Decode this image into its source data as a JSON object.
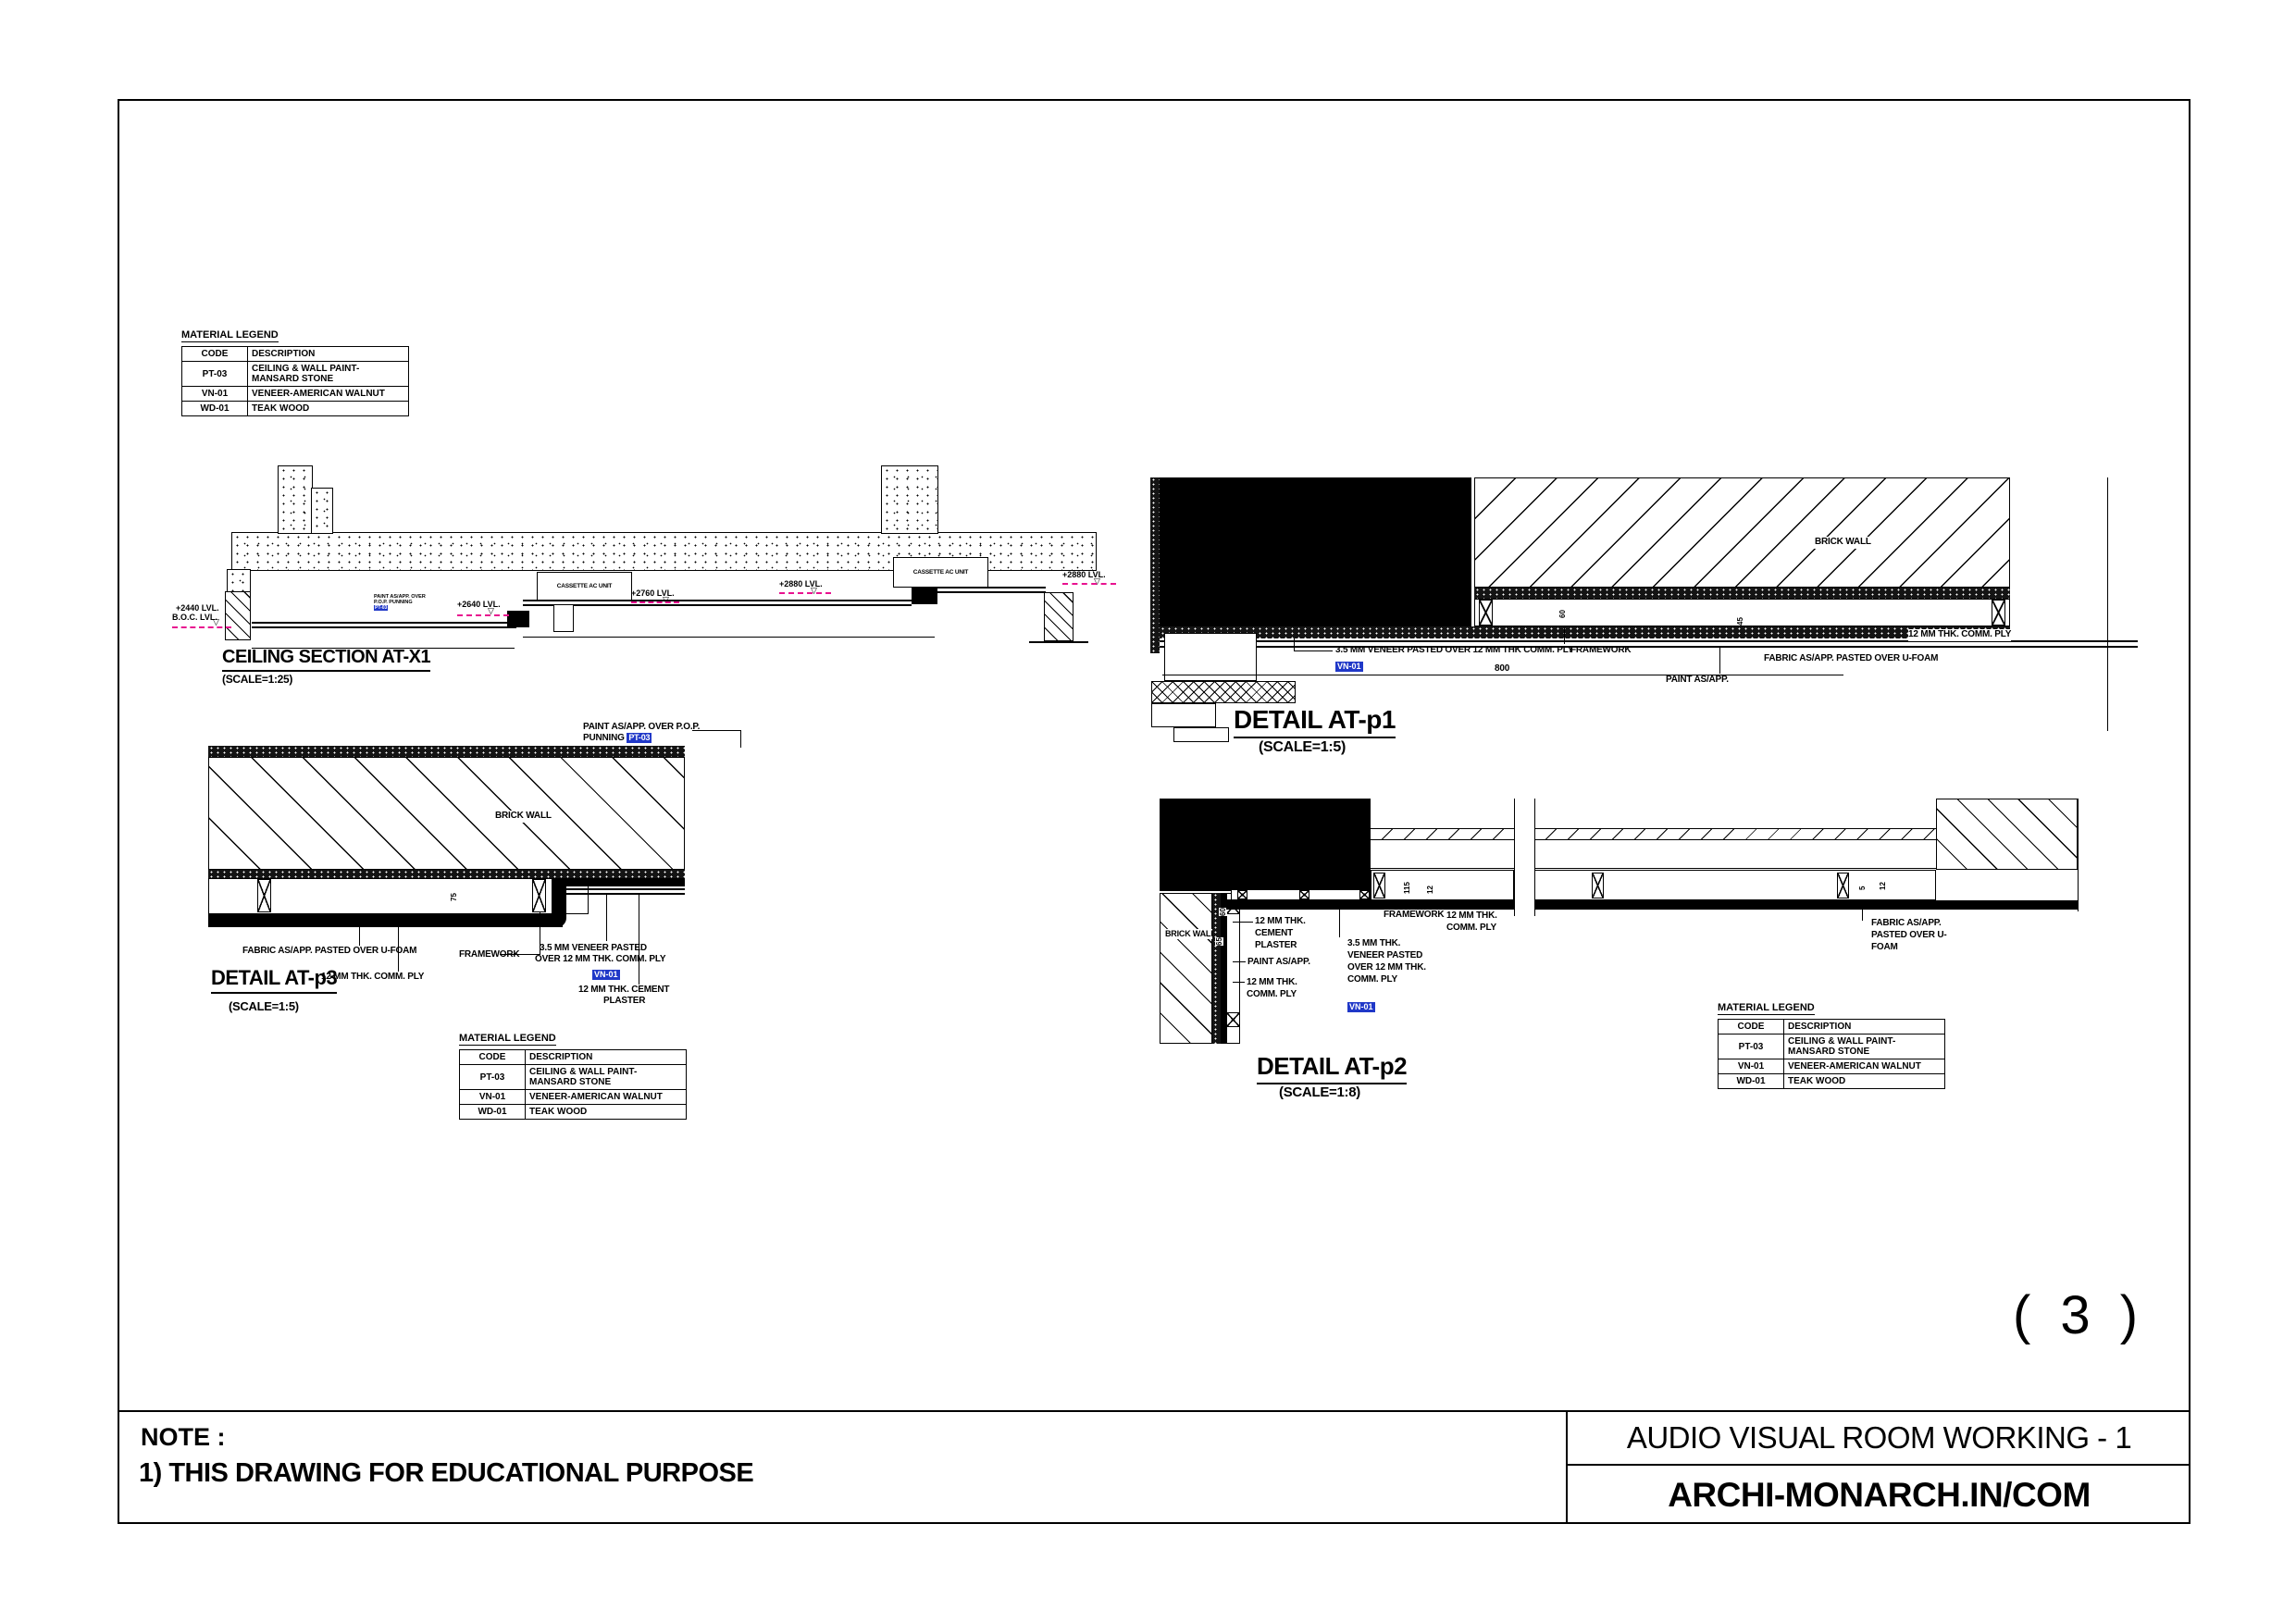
{
  "page": {
    "number": "( 3 )"
  },
  "note": {
    "heading": "NOTE :",
    "line_1": "1) THIS DRAWING FOR EDUCATIONAL PURPOSE"
  },
  "title_block": {
    "project": "AUDIO VISUAL ROOM WORKING - 1",
    "brand": "ARCHI-MONARCH.IN/COM"
  },
  "legend": {
    "title": "MATERIAL LEGEND",
    "columns": {
      "code": "CODE",
      "desc": "DESCRIPTION"
    },
    "rows": [
      {
        "code": "PT-03",
        "desc": "CEILING & WALL PAINT-MANSARD STONE"
      },
      {
        "code": "VN-01",
        "desc": "VENEER-AMERICAN WALNUT"
      },
      {
        "code": "WD-01",
        "desc": "TEAK WOOD"
      }
    ]
  },
  "colors": {
    "tag_blue": "#2038C8",
    "level_magenta": "#E8128F"
  },
  "ceiling_section": {
    "title": "CEILING SECTION AT-X1",
    "scale": "(SCALE=1:25)",
    "ac_unit_1": "CASSETTE AC UNIT",
    "ac_unit_2": "CASSETTE AC UNIT",
    "level_2440": "+2440 LVL.",
    "level_boc": "B.O.C. LVL.",
    "level_2640": "+2640 LVL.",
    "level_2760": "+2760 LVL.",
    "level_2880_mid": "+2880 LVL.",
    "level_2880_right": "+2880 LVL.",
    "tiny_note_line_1": "PAINT AS/APP. OVER",
    "tiny_note_line_2": "P.O.P. PUNNING",
    "tiny_note_tag": "PT-03"
  },
  "detail_p1": {
    "title": "DETAIL AT-p1",
    "scale": "(SCALE=1:5)",
    "brick_wall": "BRICK WALL",
    "veneer": "3.5 MM VENEER PASTED OVER 12 MM THK COMM. PLY",
    "veneer_tag": "VN-01",
    "framework": "FRAMEWORK",
    "paint": "PAINT AS/APP.",
    "fabric": "FABRIC AS/APP. PASTED OVER U-FOAM",
    "ply": "12 MM THK. COMM. PLY",
    "dim_800": "800",
    "dim_60": "60",
    "dim_45": "45"
  },
  "detail_p3": {
    "title": "DETAIL AT-p3",
    "scale": "(SCALE=1:5)",
    "paint_note_line_1": "PAINT AS/APP. OVER P.O.P.",
    "paint_note_line_2": "PUNNING",
    "paint_tag": "PT-03",
    "brick_wall": "BRICK WALL",
    "fabric": "FABRIC AS/APP. PASTED OVER U-FOAM",
    "ply": "12 MM THK. COMM. PLY",
    "framework": "FRAMEWORK",
    "veneer_line_1": "3.5 MM VENEER PASTED",
    "veneer_line_2": "OVER 12 MM THK. COMM. PLY",
    "veneer_tag": "VN-01",
    "cement_line_1": "12 MM THK. CEMENT",
    "cement_line_2": "PLASTER",
    "dim_75": "75",
    "dim_60": "60"
  },
  "detail_p2": {
    "title": "DETAIL AT-p2",
    "scale": "(SCALE=1:8)",
    "brick_wall": "BRICK WALL",
    "cement": "12 MM THK. CEMENT PLASTER",
    "paint": "PAINT AS/APP.",
    "ply_left": "12 MM THK. COMM. PLY",
    "veneer": "3.5 MM THK. VENEER PASTED OVER 12 MM THK. COMM. PLY",
    "veneer_tag": "VN-01",
    "framework": "FRAMEWORK",
    "ply_right": "12 MM THK. COMM. PLY",
    "fabric": "FABRIC AS/APP. PASTED OVER U-FOAM",
    "dim_115": "115",
    "dim_12": "12",
    "dim_60": "60",
    "dim_65": "65",
    "dim_5": "5",
    "dim_12b": "12"
  }
}
